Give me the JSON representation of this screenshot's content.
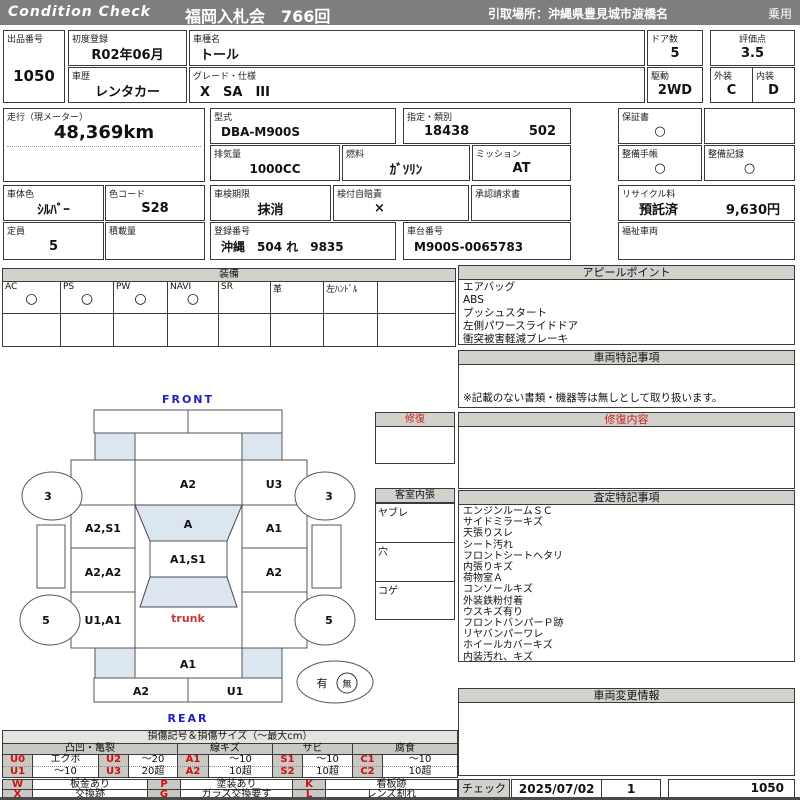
{
  "header": {
    "brand": "Condition  Check",
    "auction": "福岡入札会　766回",
    "pickup": "引取場所：沖縄県豊見城市渡橋名",
    "category": "乗用"
  },
  "fields": {
    "lot": {
      "label": "出品番号",
      "value": "1050"
    },
    "first_reg": {
      "label": "初度登録",
      "value": "R02年06月"
    },
    "model_name": {
      "label": "車種名",
      "value": "トール"
    },
    "history": {
      "label": "車歴",
      "value": "レンタカー"
    },
    "grade": {
      "label": "グレード・仕様",
      "value": "X　SA　III"
    },
    "doors": {
      "label": "ドア数",
      "value": "5"
    },
    "drive": {
      "label": "駆動",
      "value": "2WD"
    },
    "score": {
      "label": "評価点",
      "value": "3.5"
    },
    "exterior": {
      "label": "外装",
      "value": "C"
    },
    "interior": {
      "label": "内装",
      "value": "D"
    },
    "mileage": {
      "label": "走行（現メーター）",
      "value": "48,369km"
    },
    "model_code": {
      "label": "型式",
      "value": "DBA-M900S"
    },
    "type_class": {
      "label": "指定・類別",
      "value1": "18438",
      "value2": "502"
    },
    "displacement": {
      "label": "排気量",
      "value": "1000CC"
    },
    "fuel": {
      "label": "燃料",
      "value": "ｶﾞｿﾘﾝ"
    },
    "transmission": {
      "label": "ミッション",
      "value": "AT"
    },
    "warranty": {
      "label": "保証書",
      "value": "○"
    },
    "maintenance_book": {
      "label": "整備手帳",
      "value": "○"
    },
    "maintenance_record": {
      "label": "整備記録",
      "value": "○"
    },
    "body_color": {
      "label": "車体色",
      "value": "ｼﾙﾊﾞｰ"
    },
    "color_code": {
      "label": "色コード",
      "value": "S28"
    },
    "capacity": {
      "label": "定員",
      "value": "5"
    },
    "load": {
      "label": "積載量",
      "value": ""
    },
    "inspection": {
      "label": "車検期限",
      "value": "抹消"
    },
    "insurance": {
      "label": "検付自賠責",
      "value": "×"
    },
    "approval": {
      "label": "承認請求書",
      "value": ""
    },
    "reg_number": {
      "label": "登録番号",
      "value": "沖縄　504 れ　9835"
    },
    "chassis": {
      "label": "車台番号",
      "value": "M900S-0065783"
    },
    "recycle": {
      "label": "リサイクル料",
      "value": "預託済",
      "amount": "9,630円"
    },
    "welfare": {
      "label": "福祉車両",
      "value": ""
    }
  },
  "equipment": {
    "title": "装備",
    "items": [
      {
        "label": "AC",
        "mark": "○"
      },
      {
        "label": "PS",
        "mark": "○"
      },
      {
        "label": "PW",
        "mark": "○"
      },
      {
        "label": "NAVI",
        "mark": "○"
      },
      {
        "label": "SR",
        "mark": ""
      },
      {
        "label": "革",
        "mark": ""
      },
      {
        "label": "左ﾊﾝﾄﾞﾙ",
        "mark": ""
      },
      {
        "label": "",
        "mark": ""
      }
    ]
  },
  "appeal": {
    "title": "アピールポイント",
    "items": [
      "エアバッグ",
      "ABS",
      "プッシュスタート",
      "左側パワースライドドア",
      "衝突被害軽減ブレーキ"
    ]
  },
  "special": {
    "title": "車両特記事項",
    "note": "※記載のない書類・機器等は無しとして取り扱います。"
  },
  "repair_content": {
    "title": "修復内容"
  },
  "repair_box": {
    "title": "修復"
  },
  "interior_box": {
    "title": "客室内張",
    "rows": [
      "ヤブレ",
      "穴",
      "コゲ"
    ]
  },
  "assessment": {
    "title": "査定特記事項",
    "items": [
      "エンジンルームＳＣ",
      "サイドミラーキズ",
      "天張りスレ",
      "シート汚れ",
      "フロントシートヘタリ",
      "内張りキズ",
      "荷物室Ａ",
      "コンソールキズ",
      "外装鉄粉付着",
      "ウスキズ有り",
      "フロントバンパーＰ跡",
      "リヤバンパーワレ",
      "ホイールカバーキズ",
      "内装汚れ、キズ"
    ]
  },
  "change_info": {
    "title": "車両変更情報"
  },
  "check": {
    "label": "チェック",
    "date": "2025/07/02",
    "count": "1",
    "number": "1050"
  },
  "diagram": {
    "front_label": "FRONT",
    "rear_label": "REAR",
    "panels": {
      "hood": "A2",
      "right_front_fender": "U3",
      "windshield": "A",
      "left_front_door": "A2,S1",
      "right_front_door": "A1",
      "roof": "A1,S1",
      "left_rear_door": "A2,A2",
      "right_rear_door": "A2",
      "left_quarter": "U1,A1",
      "trunk": "trunk",
      "rear_panel": "A1",
      "rear_bumper_left": "A2",
      "rear_bumper_right": "U1"
    },
    "tires": {
      "front_left": "3",
      "front_right": "3",
      "rear_left": "5",
      "rear_right": "5"
    },
    "spare": {
      "has": "有",
      "none": "無"
    }
  },
  "legend": {
    "title": "損傷記号＆損傷サイズ（～最大cm）",
    "groups": [
      "凸凹・亀裂",
      "線キズ",
      "サビ",
      "腐食"
    ],
    "row1": [
      "U0",
      "エクボ",
      "U2",
      "～20",
      "A1",
      "～10",
      "S1",
      "～10",
      "C1",
      "～10"
    ],
    "row2": [
      "U1",
      "～10",
      "U3",
      "20超",
      "A2",
      "10超",
      "S2",
      "10超",
      "C2",
      "10超"
    ],
    "row3": [
      "W",
      "板金あり",
      "P",
      "塗装あり",
      "K",
      "看板跡"
    ],
    "row4": [
      "X",
      "交換跡",
      "G",
      "ガラス交換要す",
      "L",
      "レンズ割れ"
    ]
  },
  "colors": {
    "header_bar": "#7e7e7e",
    "section_header": "#d2d1cb",
    "shaded_panel": "#dce6f1",
    "accent_red": "#cc2020",
    "accent_blue": "#2020bb"
  }
}
